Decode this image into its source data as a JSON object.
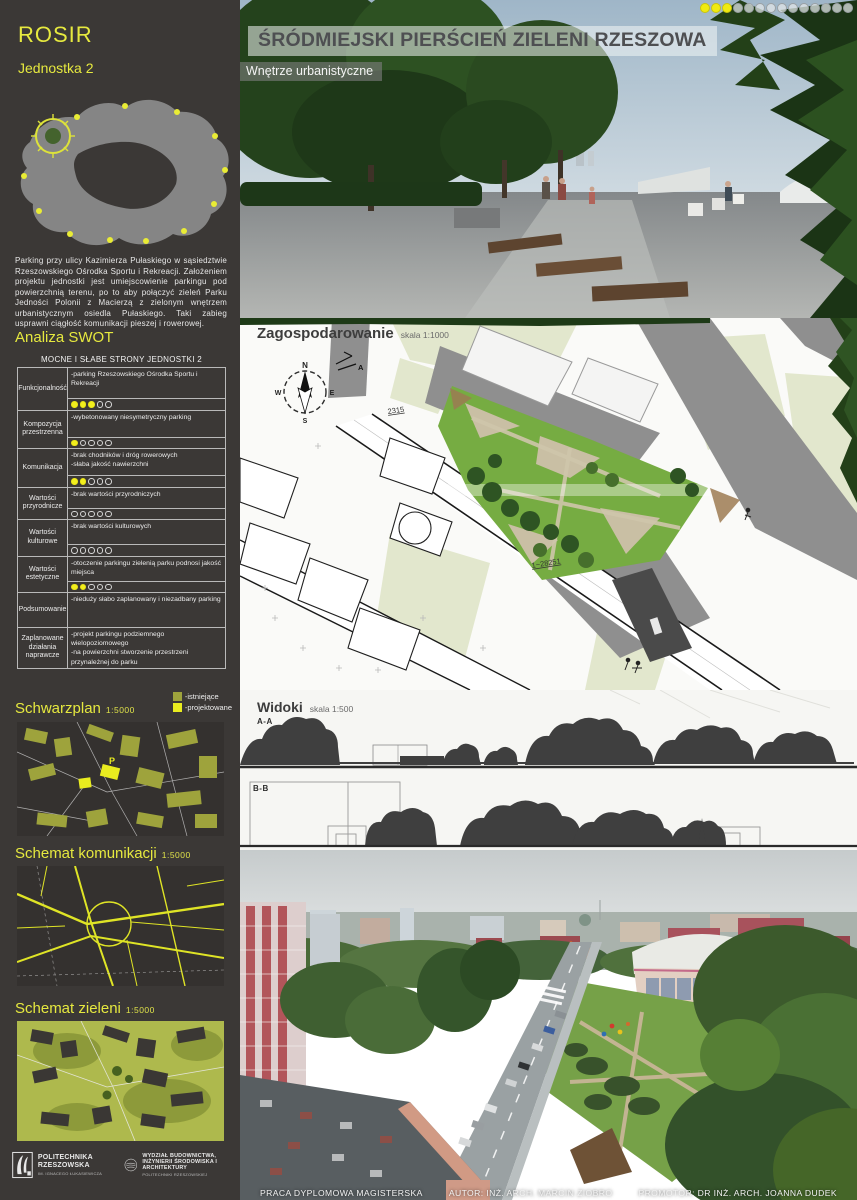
{
  "header": {
    "title": "ŚRÓDMIEJSKI PIERŚCIEŃ ZIELENI RZESZOWA",
    "subtitle": "Wnętrze urbanistyczne",
    "progress_dots": {
      "filled": 3,
      "total": 14
    }
  },
  "sidebar": {
    "logo": "ROSIR",
    "unit_label": "Jednostka 2",
    "description": "Parking przy ulicy Kazimierza Pułaskiego w sąsiedztwie Rzeszowskiego Ośrodka Sportu i Rekreacji. Założeniem projektu jednostki jest umiejscowienie parkingu pod powierzchnią terenu, po to aby połączyć zieleń Parku Jedności Polonii z Macierzą z zielonym wnętrzem urbanistycznym osiedla Pułaskiego. Taki zabieg usprawni ciągłość komunikacji pieszej i rowerowej.",
    "swot_heading": "Analiza SWOT",
    "swot": {
      "table_title": "MOCNE I SŁABE STRONY JEDNOSTKI 2",
      "rows": [
        {
          "label": "Funkcjonalność",
          "text": "-parking Rzeszowskiego Ośrodka Sportu i Rekreacji",
          "score": 3,
          "max": 5
        },
        {
          "label": "Kompozycja przestrzenna",
          "text": "-wybetonowany niesymetryczny parking",
          "score": 1,
          "max": 5
        },
        {
          "label": "Komunikacja",
          "text": "-brak chodników i dróg rowerowych\n-słaba jakość nawierzchni",
          "score": 2,
          "max": 5
        },
        {
          "label": "Wartości przyrodnicze",
          "text": "-brak wartości  przyrodniczych",
          "score": 0,
          "max": 5
        },
        {
          "label": "Wartości kulturowe",
          "text": "-brak wartości  kulturowych",
          "score": 0,
          "max": 5
        },
        {
          "label": "Wartości estetyczne",
          "text": "-otoczenie parkingu zielenią parku podnosi jakość miejsca",
          "score": 2,
          "max": 5
        },
        {
          "label": "Podsumowanie",
          "text": "-nieduży słabo zaplanowany i niezadbany parking",
          "score": null
        },
        {
          "label": "Zaplanowane działania naprawcze",
          "text": "-projekt parkingu podziemnego wielopoziomowego\n-na powierzchni stworzenie przestrzeni przynależnej do parku",
          "score": null
        }
      ]
    },
    "legend": {
      "existing": "-istniejące",
      "planned": "-projektowane"
    },
    "maps": [
      {
        "title": "Schwarzplan",
        "scale": "1:5000"
      },
      {
        "title": "Schemat komunikacji",
        "scale": "1:5000"
      },
      {
        "title": "Schemat zieleni",
        "scale": "1:5000"
      }
    ],
    "logos": [
      {
        "name": "POLITECHNIKA RZESZOWSKA",
        "sub": "IM. IGNACEGO ŁUKASIEWICZA"
      },
      {
        "name": "WYDZIAŁ BUDOWNICTWA, INŻYNIERII ŚRODOWISKA I ARCHITEKTURY",
        "sub": "POLITECHNIKI RZESZOWSKIEJ"
      }
    ]
  },
  "plan": {
    "title": "Zagospodarowanie",
    "scale": "skala 1:1000",
    "labels": [
      "2315",
      "1−28251"
    ],
    "compass": [
      "N",
      "E",
      "S",
      "W"
    ],
    "section_marker": "A"
  },
  "views": {
    "title": "Widoki",
    "scale": "skala 1:500",
    "sections": [
      "A-A",
      "B-B"
    ]
  },
  "footer": {
    "project": "PRACA DYPLOMOWA MAGISTERSKA",
    "author": "AUTOR: INŻ. ARCH. MARCIN ZIOBRO",
    "promoter": "PROMOTOR: DR INŻ. ARCH. JOANNA DUDEK"
  },
  "colors": {
    "accent_yellow": "#e6e93f",
    "rating_yellow": "#f2ee1e",
    "legend_olive": "#9ea33c",
    "legend_bright": "#e9ec1f",
    "sidebar_bg": "#3b3836",
    "park_green": "#76a148"
  }
}
